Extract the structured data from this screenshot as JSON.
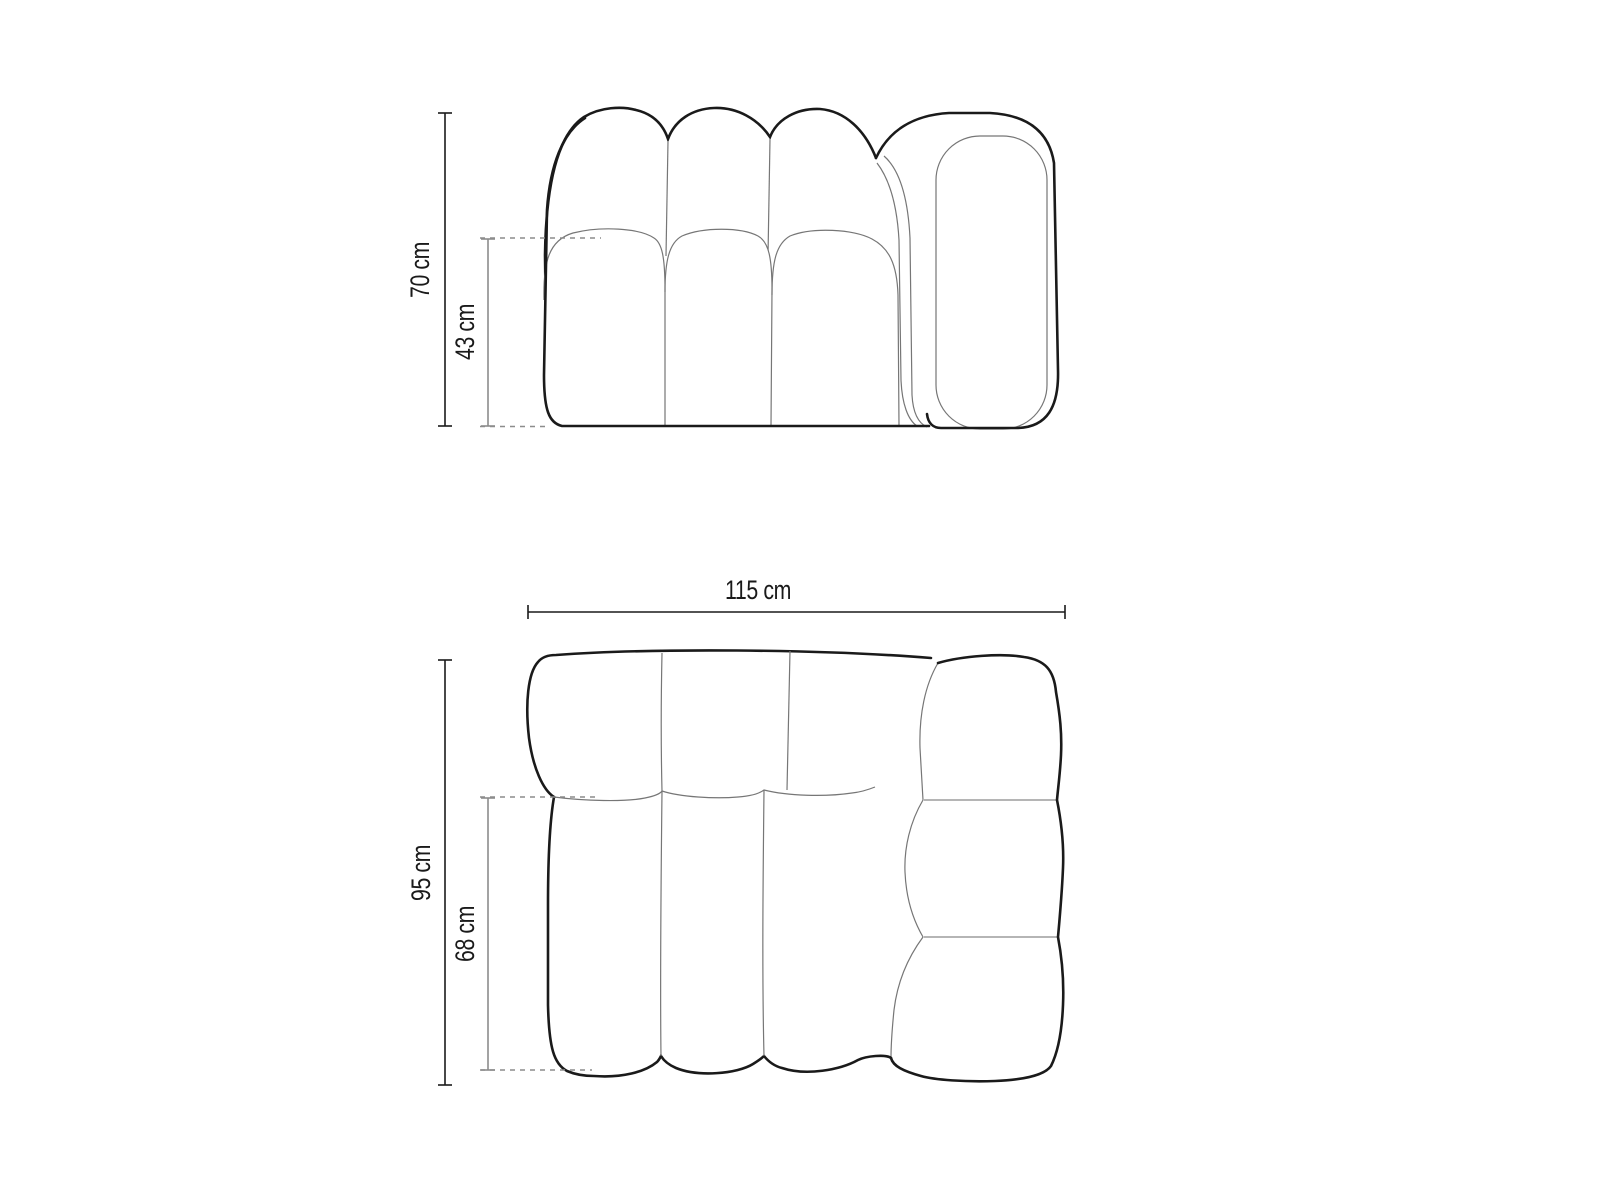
{
  "title": "Modular sofa technical dimension drawing",
  "colors": {
    "background": "#ffffff",
    "outline": "#1a1a1a",
    "seam": "#767676",
    "panel_divider": "#b5b5b5",
    "dimension_primary": "#1a1a1a",
    "dimension_secondary": "#8c8c8c",
    "dashed_guide": "#8c8c8c",
    "label_text": "#1a1a1a"
  },
  "front_view": {
    "name": "front elevation of left-arm sofa module",
    "total_height": {
      "label": "70 cm",
      "value_cm": 70
    },
    "seat_height": {
      "label": "43 cm",
      "value_cm": 43
    }
  },
  "top_view": {
    "name": "top plan of left-arm sofa module",
    "total_width": {
      "label": "115 cm",
      "value_cm": 115
    },
    "total_depth": {
      "label": "95 cm",
      "value_cm": 95
    },
    "seat_depth": {
      "label": "68 cm",
      "value_cm": 68
    }
  }
}
